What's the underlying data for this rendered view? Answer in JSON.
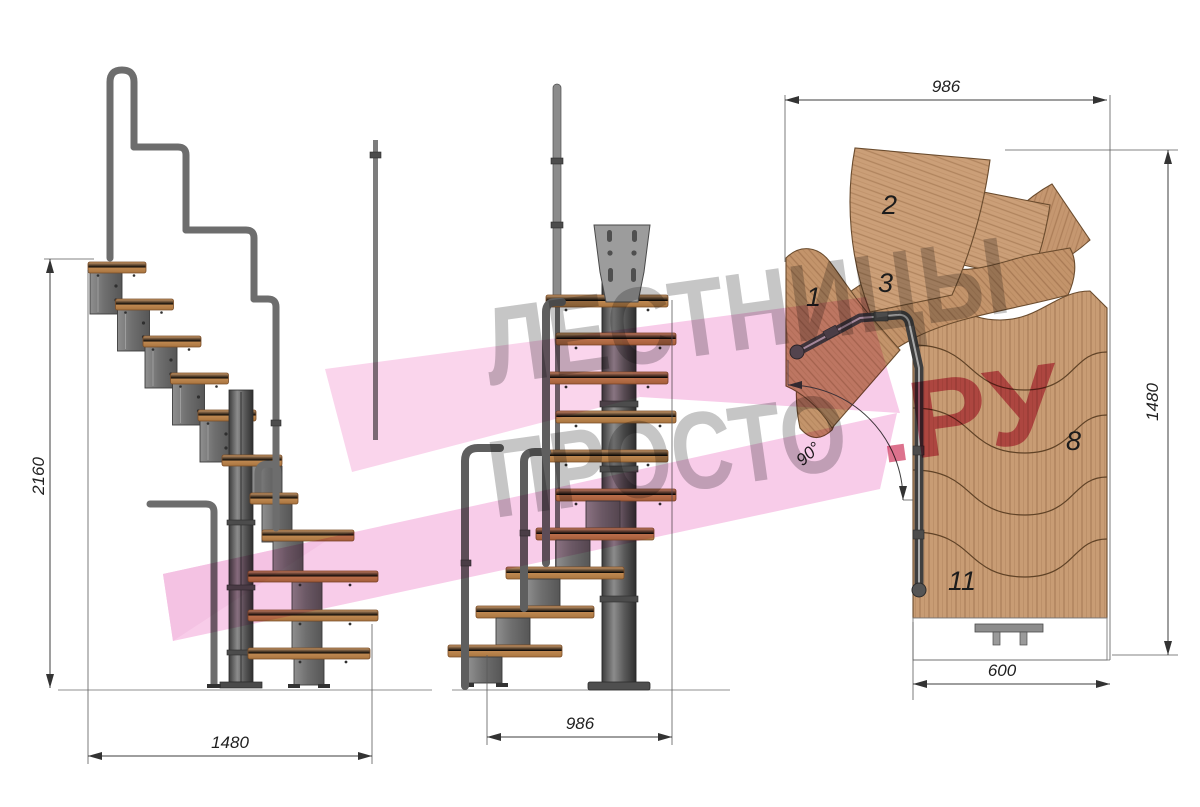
{
  "watermark": {
    "line1": "ЛЕСТНИЦЫ",
    "line2": "ПРОСТО",
    "suffix": ".РУ"
  },
  "views": {
    "side": {
      "height": "2160",
      "run": "1480"
    },
    "front": {
      "width": "986"
    },
    "plan": {
      "width": "986",
      "depth": "1480",
      "flight_width": "600",
      "turn_angle": "90°",
      "steps": {
        "s1": "1",
        "s2": "2",
        "s3": "3",
        "s8": "8",
        "s11": "11"
      }
    }
  },
  "colors": {
    "wood": "#c89c74",
    "metal": "#7b7b7b",
    "watermark_gray": "#a3a3a3",
    "watermark_pink": "#d44f70",
    "logo_pink": "#f2a2d6"
  }
}
